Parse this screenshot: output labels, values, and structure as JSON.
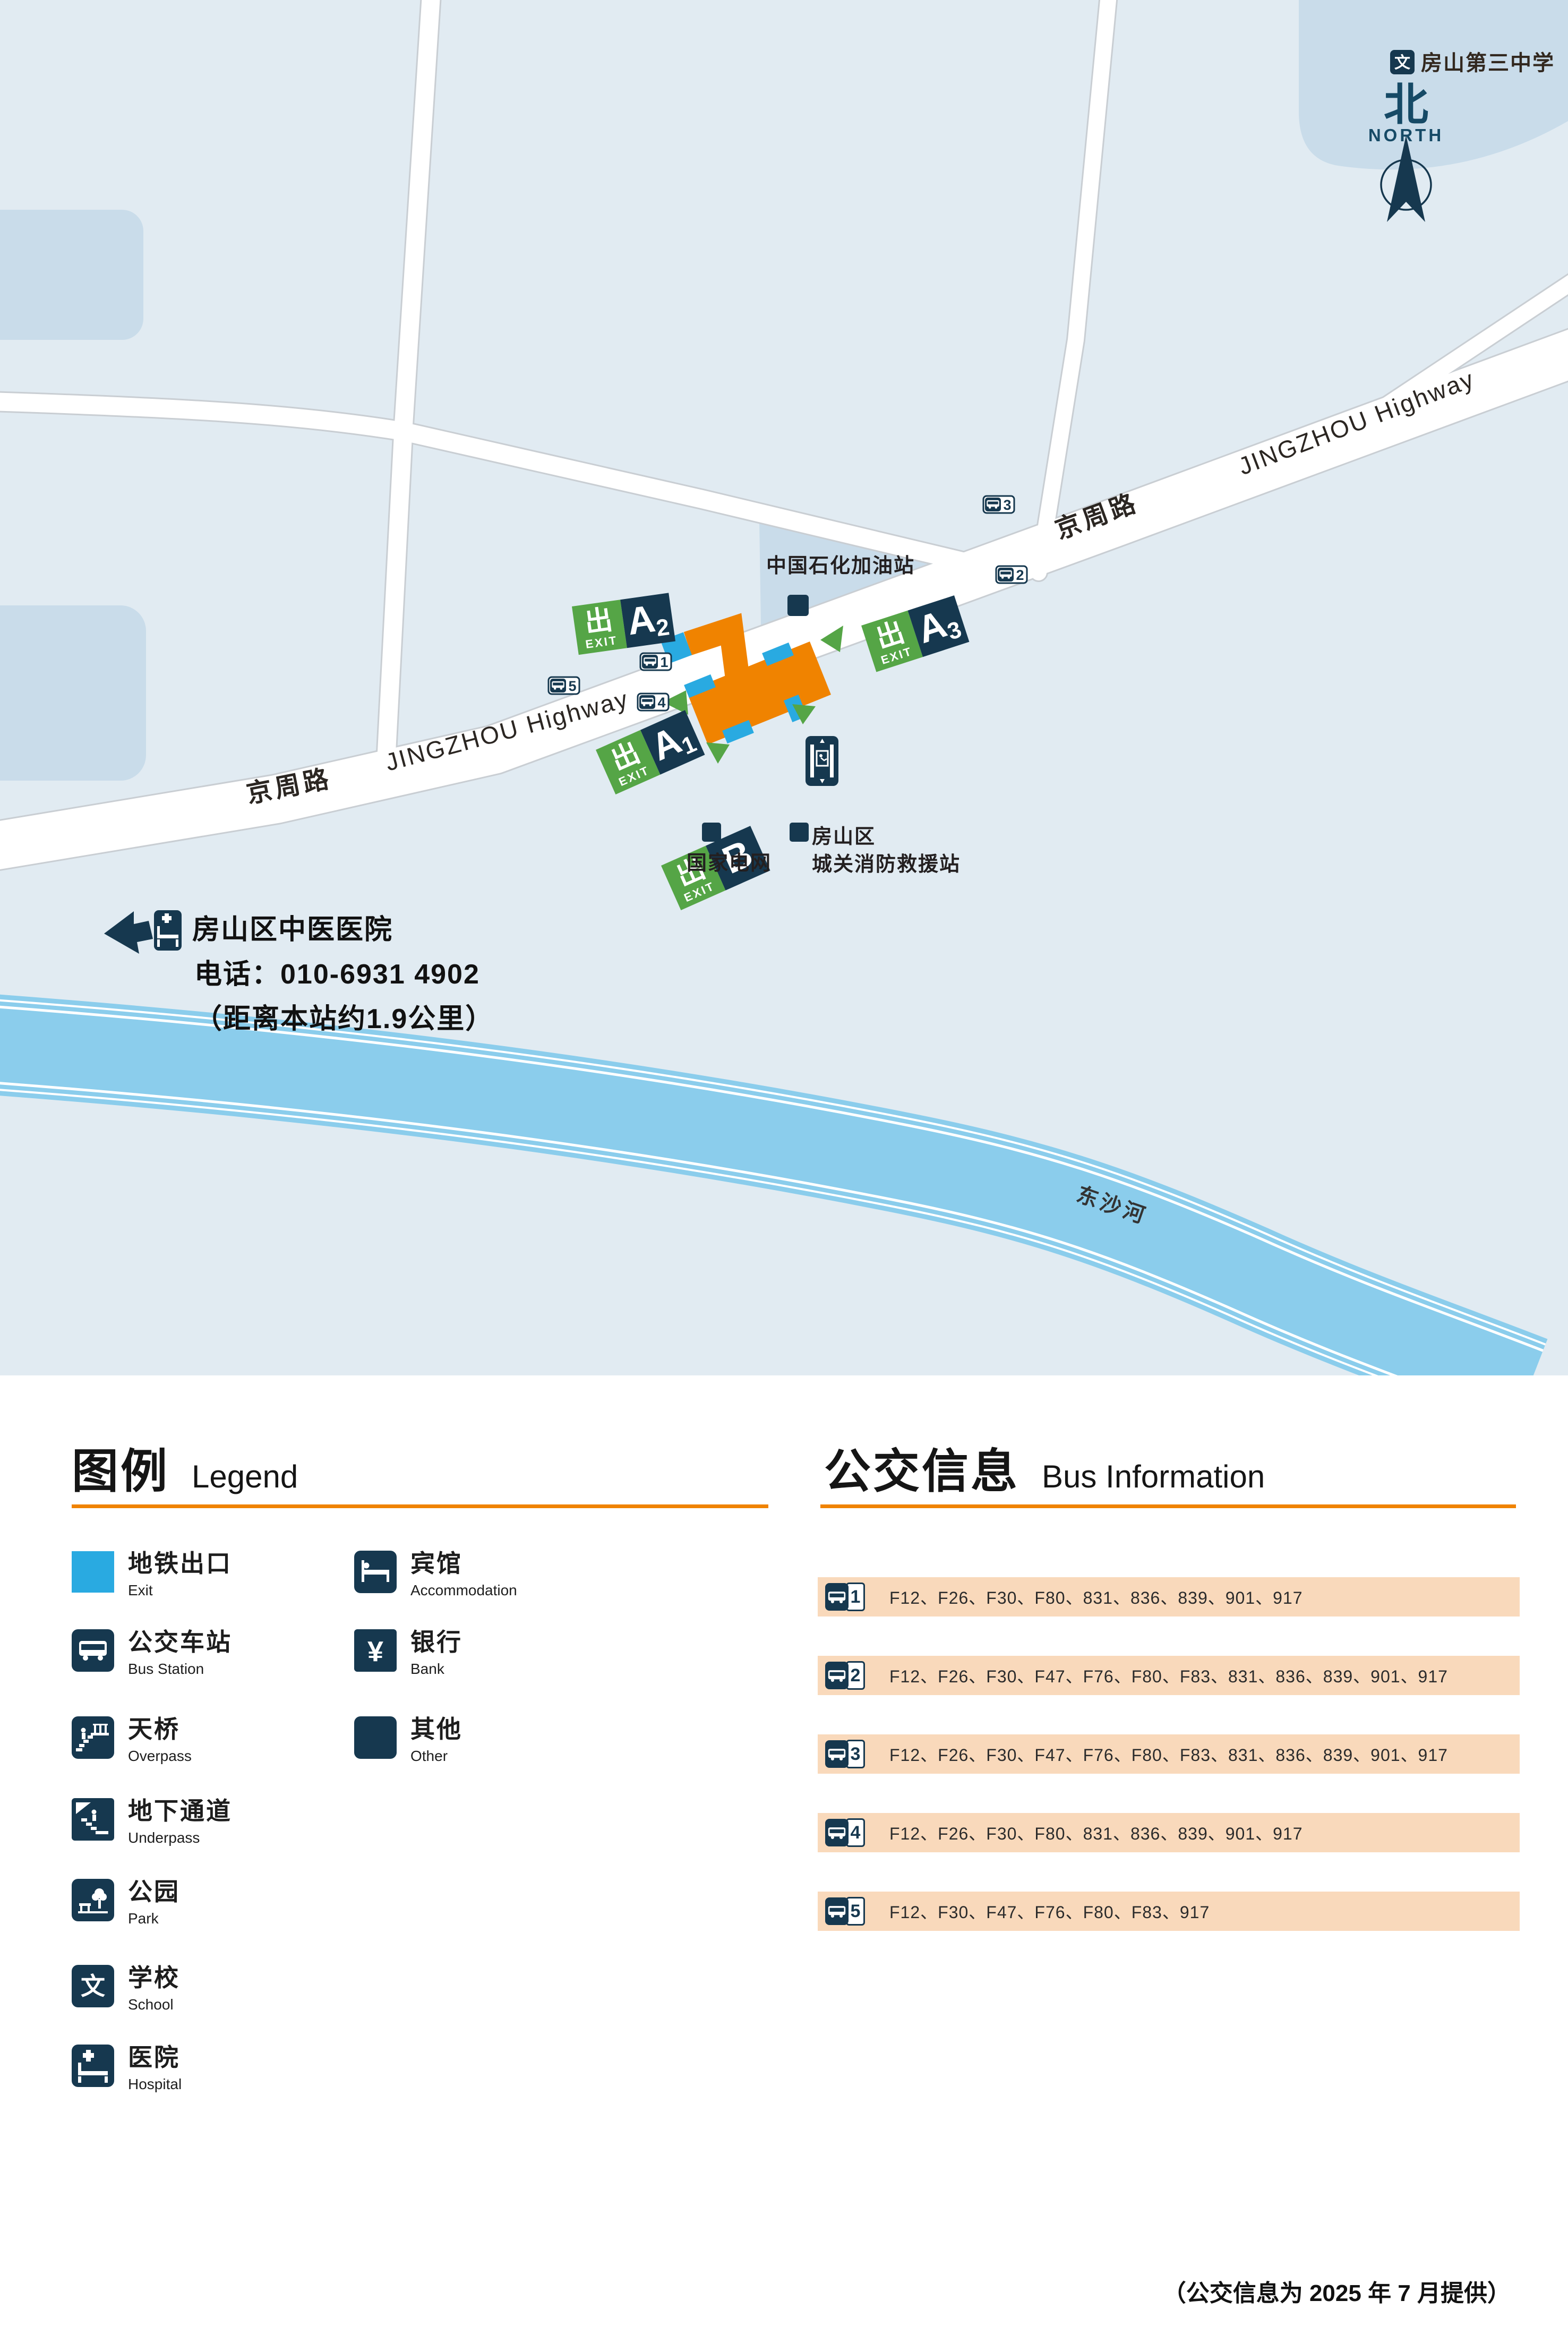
{
  "map": {
    "school": {
      "label": "房山第三中学",
      "icon_char": "文"
    },
    "north": {
      "char": "北",
      "label": "NORTH"
    },
    "road": {
      "name_cn": "京周路",
      "name_en": "JINGZHOU Highway"
    },
    "river": {
      "name": "东沙河"
    },
    "gas_station": {
      "label": "中国石化加油站"
    },
    "state_grid": {
      "label": "国家电网"
    },
    "fire_station": {
      "line1": "房山区",
      "line2": "城关消防救援站"
    },
    "hospital": {
      "name": "房山区中医医院",
      "phone": "电话：010-6931 4902",
      "distance": "（距离本站约1.9公里）"
    },
    "exit_logo": {
      "char": "出",
      "text": "EXIT"
    },
    "exits": [
      {
        "main": "A",
        "sub": "2"
      },
      {
        "main": "A",
        "sub": "3"
      },
      {
        "main": "A",
        "sub": "1"
      },
      {
        "main": "B",
        "sub": ""
      }
    ],
    "bus_stops": [
      "1",
      "2",
      "3",
      "4",
      "5"
    ]
  },
  "legend": {
    "title_cn": "图例",
    "title_en": "Legend",
    "items_left": [
      {
        "cn": "地铁出口",
        "en": "Exit"
      },
      {
        "cn": "公交车站",
        "en": "Bus Station"
      },
      {
        "cn": "天桥",
        "en": "Overpass"
      },
      {
        "cn": "地下通道",
        "en": "Underpass"
      },
      {
        "cn": "公园",
        "en": "Park"
      },
      {
        "cn": "学校",
        "en": "School"
      },
      {
        "cn": "医院",
        "en": "Hospital"
      }
    ],
    "items_right": [
      {
        "cn": "宾馆",
        "en": "Accommodation"
      },
      {
        "cn": "银行",
        "en": "Bank"
      },
      {
        "cn": "其他",
        "en": "Other"
      }
    ]
  },
  "bus_info": {
    "title_cn": "公交信息",
    "title_en": "Bus Information",
    "rows": [
      {
        "number": "1",
        "routes": "F12、F26、F30、F80、831、836、839、901、917"
      },
      {
        "number": "2",
        "routes": "F12、F26、F30、F47、F76、F80、F83、831、836、839、901、917"
      },
      {
        "number": "3",
        "routes": "F12、F26、F30、F47、F76、F80、F83、831、836、839、901、917"
      },
      {
        "number": "4",
        "routes": "F12、F26、F30、F80、831、836、839、901、917"
      },
      {
        "number": "5",
        "routes": "F12、F30、F47、F76、F80、F83、917"
      }
    ]
  },
  "footer": {
    "note": "（公交信息为 2025 年 7 月提供）"
  },
  "colors": {
    "navy": "#16384f",
    "cyan": "#29aae1",
    "green": "#55a546",
    "orange": "#f08300",
    "peach": "#f9d9bb",
    "river": "#8bcdec",
    "map_bg": "#e1ebf2",
    "block": "#c9dcea"
  }
}
